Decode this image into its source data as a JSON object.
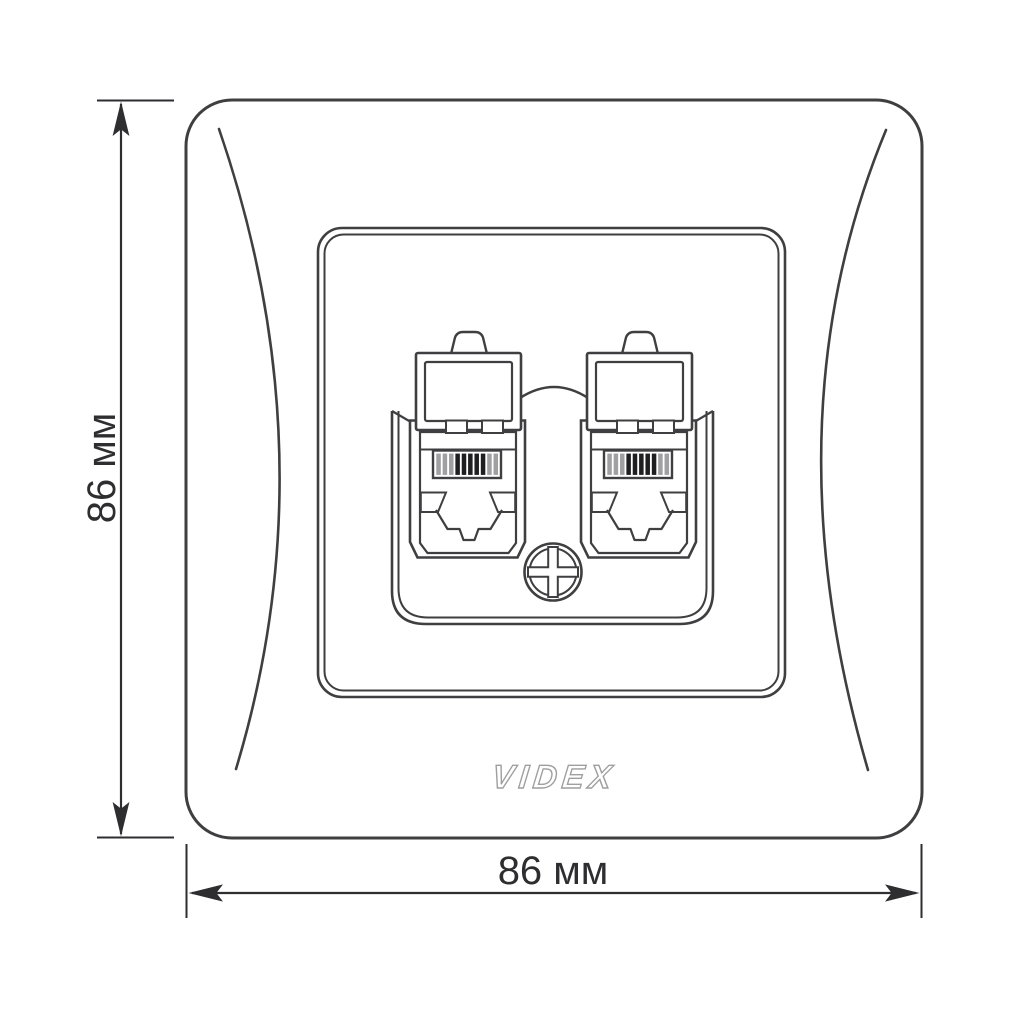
{
  "diagram": {
    "brand": "VIDEX",
    "height_label": "86 мм",
    "width_label": "86 мм",
    "colors": {
      "line": "#3f3f41",
      "dimension": "#2e2e30",
      "logo_outline": "#9f9f9f",
      "contact_bar_dark": "#1e1e20",
      "contact_bar_light": "#a0a0a2",
      "background": "#ffffff"
    },
    "contact_bars": [
      "light",
      "light",
      "light",
      "dark",
      "dark",
      "dark",
      "dark",
      "dark",
      "light",
      "light"
    ],
    "icons": {
      "screw": "phillips-screw-icon",
      "up_arrow": "dimension-arrow-up-icon",
      "down_arrow": "dimension-arrow-down-icon",
      "left_arrow": "dimension-arrow-left-icon",
      "right_arrow": "dimension-arrow-right-icon"
    }
  }
}
